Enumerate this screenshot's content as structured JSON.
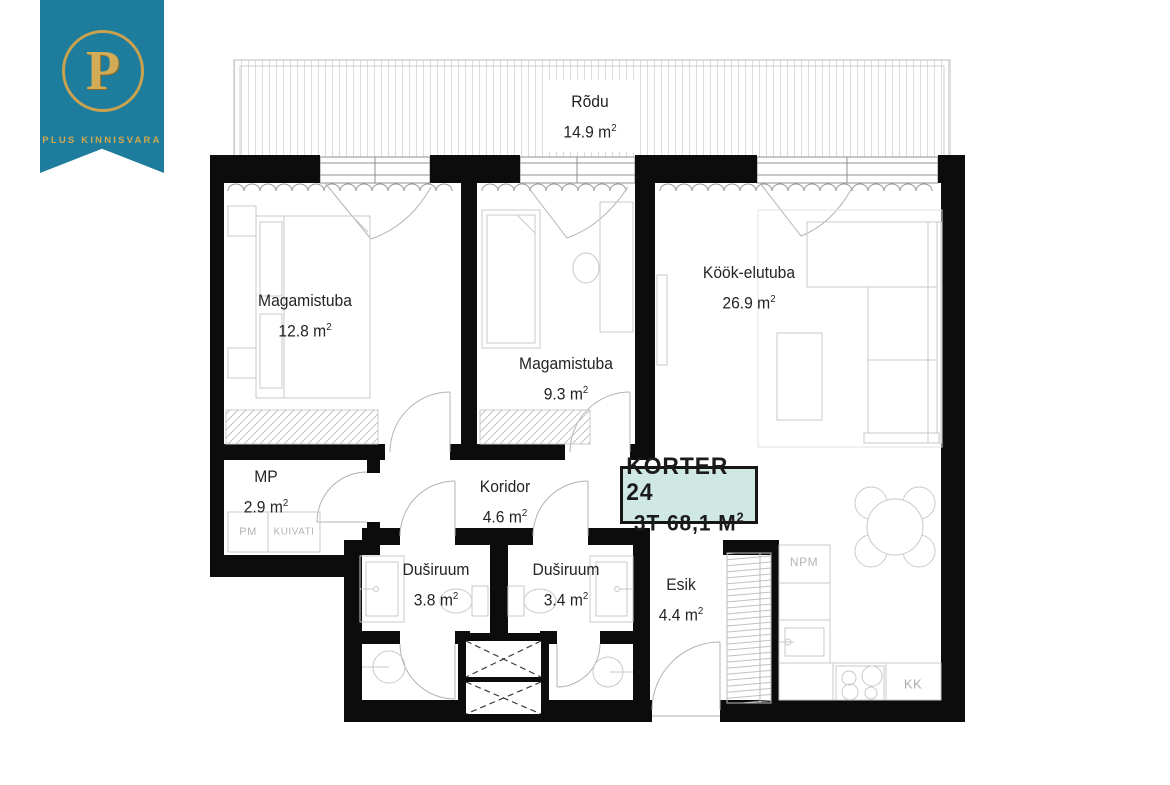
{
  "logo": {
    "letter": "P",
    "company": "PLUS KINNISVARA",
    "banner_color": "#1e7d9c",
    "gold_color": "#c8a24e"
  },
  "badge": {
    "line1": "KORTER 24",
    "line2": "3T 68,1 M",
    "sup": "2",
    "bg_color": "#cfe8e3"
  },
  "units": {
    "sq": "m",
    "sup": "2"
  },
  "rooms": {
    "rodu": {
      "name": "Rõdu",
      "area": "14.9"
    },
    "magamistuba1": {
      "name": "Magamistuba",
      "area": "12.8"
    },
    "magamistuba2": {
      "name": "Magamistuba",
      "area": "9.3"
    },
    "kook_elutuba": {
      "name": "Köök-elutuba",
      "area": "26.9"
    },
    "mp": {
      "name": "MP",
      "area": "2.9"
    },
    "koridor": {
      "name": "Koridor",
      "area": "4.6"
    },
    "dusiruum1": {
      "name": "Duširuum",
      "area": "3.8"
    },
    "dusiruum2": {
      "name": "Duširuum",
      "area": "3.4"
    },
    "esik": {
      "name": "Esik",
      "area": "4.4"
    }
  },
  "appliances": {
    "pm": "PM",
    "kuivati": "KUIVATI",
    "npm": "NPM",
    "kk": "KK"
  },
  "colors": {
    "wall": "#0c0c0c",
    "furniture_line": "#c9c9c9"
  }
}
